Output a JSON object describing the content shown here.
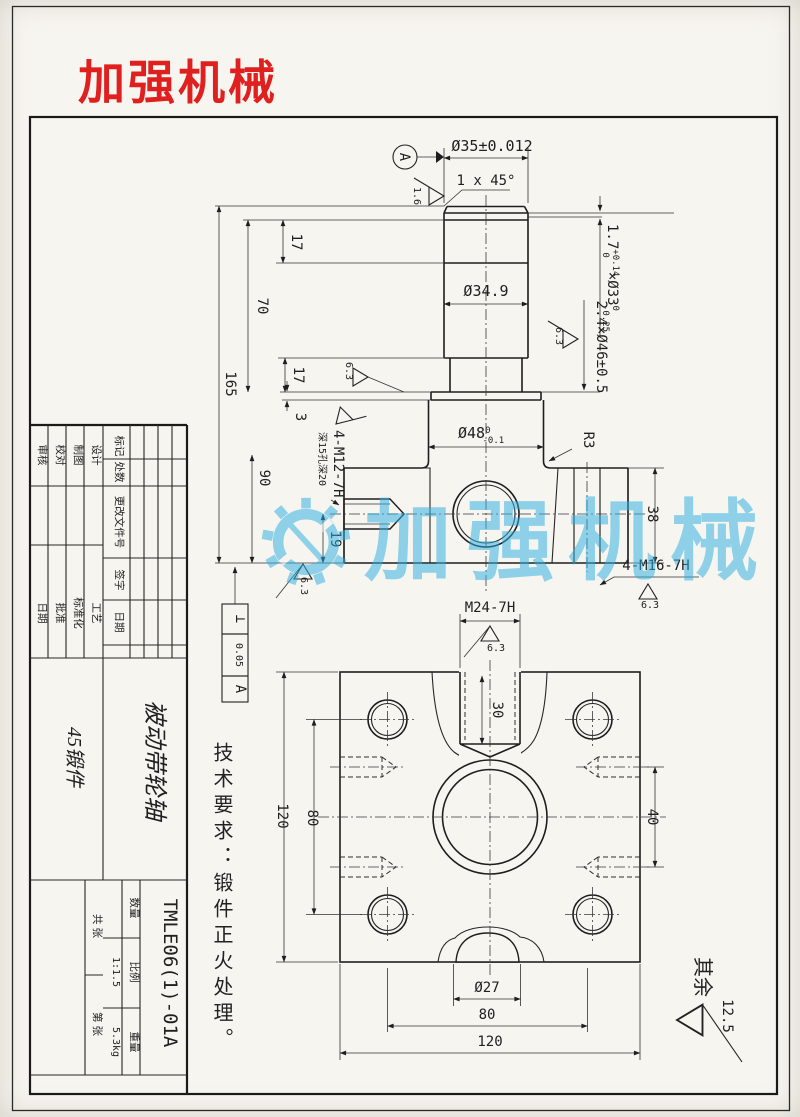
{
  "logo": {
    "text": "加强机械",
    "color": "#e01f1f"
  },
  "watermark": {
    "text": "加强机械",
    "color": "#2fb0e2"
  },
  "tech_note": {
    "text": "技术要求：锻件正火处理。"
  },
  "rest": {
    "label": "其余",
    "value": "12.5"
  },
  "title_block": {
    "part_name": "被动带轮轴",
    "material": "45锻件",
    "drawing_no": "TMLE06(1)-01A",
    "scale_label": "比例",
    "scale_value": "1:1.5",
    "weight_label": "重量",
    "weight_value": "5.3kg",
    "qty_label": "数量",
    "sheets_label": "共 张",
    "sheet_no_label": "第 张",
    "rev": {
      "mark": "标记",
      "count": "处数",
      "doc": "更改文件号",
      "sign": "签字",
      "date": "日期"
    },
    "roles": {
      "design": "设计",
      "draft": "制图",
      "check": "校对",
      "audit": "审核",
      "process": "工艺",
      "standardize": "标准化",
      "approve": "批准",
      "date": "日期"
    }
  },
  "dims": {
    "d35": "Ø35±0.012",
    "chamfer": "1 x 45°",
    "datum": "A",
    "ra16": "1.6",
    "ra63": "6.3",
    "groove1": {
      "b1": "1.7",
      "sup1": "+0.14",
      "sub1": "0",
      "b2": "×Ø33",
      "sup2": "0",
      "sub2": "-0.25"
    },
    "d349": "Ø34.9",
    "groove2": "2.4×Ø46±0.5",
    "d48": {
      "b": "Ø48",
      "sup": "0",
      "sub": "-0.1"
    },
    "m12": "4-M12-7H",
    "m12_note": "深15孔深20",
    "m16": "4-M16-7H",
    "m24": "M24-7H",
    "r3": "R3",
    "d27": "Ø27",
    "v165": "165",
    "v90": "90",
    "v70": "70",
    "v17": "17",
    "v3": "3",
    "v19": "19",
    "v38": "38",
    "v30": "30",
    "v40": "40",
    "v80": "80",
    "v120": "120",
    "tol": {
      "sym": "⊥",
      "val": "0.05",
      "ref": "A"
    }
  }
}
